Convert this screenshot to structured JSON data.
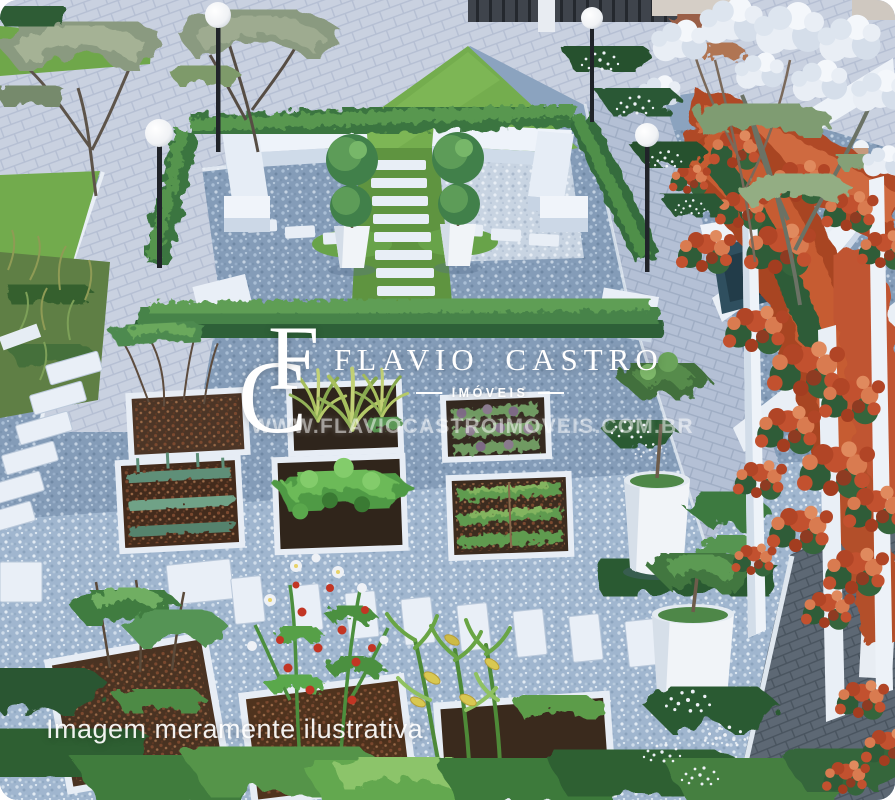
{
  "meta": {
    "kind": "real-estate architectural render",
    "subject": "aerial 3D view of a condominium community vegetable garden"
  },
  "watermark": {
    "logo_letter_c": "C",
    "logo_letter_f": "F",
    "brand_name": "FLAVIO CASTRO",
    "brand_tagline": "IMÓVEIS",
    "website": "WWW.FLAVIOCASTROIMOVEIS.COM.BR",
    "text_color": "#ffffff"
  },
  "caption": {
    "disclaimer": "Imagem meramente ilustrativa"
  },
  "scene": {
    "elements": [
      "paved plaza",
      "globe lamp posts",
      "hedged seating square with white benches",
      "potted topiaries",
      "stepping-stone paths",
      "raised vegetable beds",
      "tomato plants",
      "corn plants",
      "pergola with red climbing flowers",
      "white flowering tree",
      "large white planter pots",
      "blue gravel ground",
      "dark brick path",
      "person sitting on curved bench"
    ],
    "colors": {
      "paving": "#c9d1e0",
      "gravel": "#8ba3bf",
      "gravel_light": "#a2b8d0",
      "grass": "#72ab4d",
      "hedge": "#3f7d45",
      "structure_white": "#edf2f8",
      "red_flowers": "#c2512f",
      "soil": "#3f2d20",
      "dark_path": "#5d6874",
      "blossoms": "#e9edf4"
    }
  }
}
